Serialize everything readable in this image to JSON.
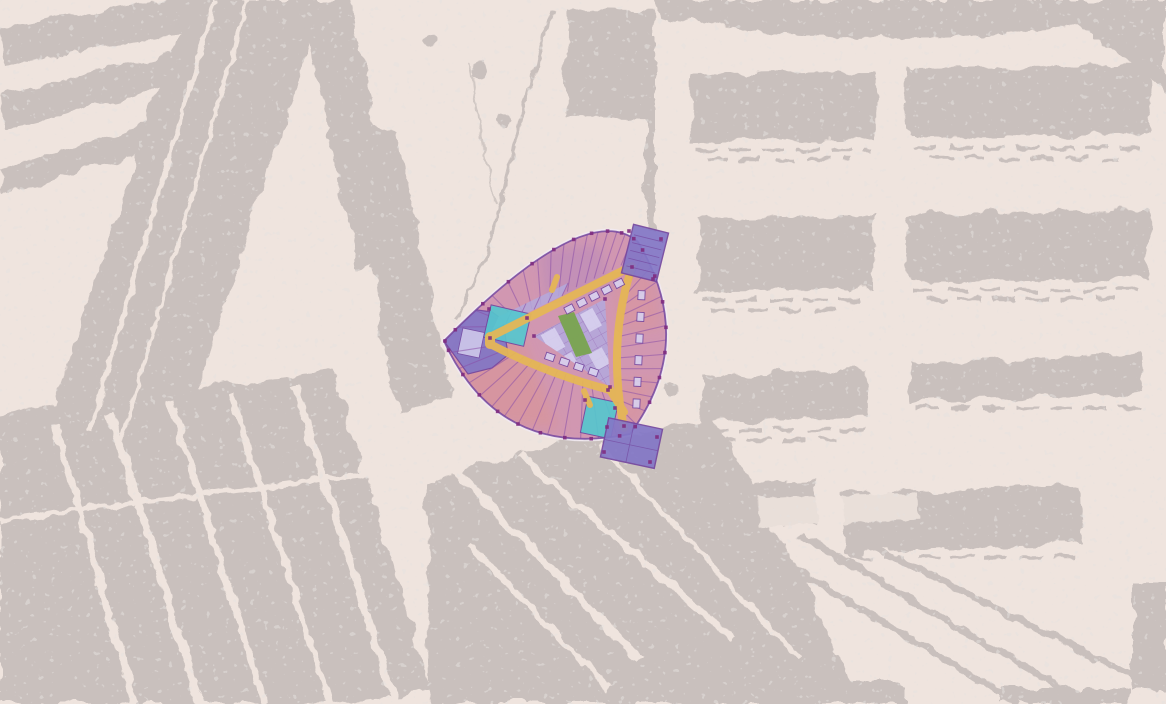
{
  "view": {
    "kind": "aerial-site-plan",
    "description_names": {
      "background": "posterized-aerial-map",
      "overlay": "building-floor-plan-overlay"
    }
  },
  "colors": {
    "map_background": "#EFE4DE",
    "map_block_gray": "#C9C0BD",
    "unit_pink": "#CB8AA9",
    "unit_salmon": "#DD9285",
    "accent_purple_tint": "#9F7FC0",
    "lavender": "#B4A9DC",
    "lavender_light": "#D8D2EF",
    "corridor_yellow": "#E5B757",
    "courtyard_green": "#79A44F",
    "core_cyan": "#56C6CE",
    "corner_block_purple": "#8377C6",
    "wall_purple": "#74479F",
    "partition_purple": "#8A4FA8",
    "column_dot_magenta": "#7F2C80",
    "plan_halo": "#F1EAF2"
  },
  "plan_zones": [
    {
      "name": "outer-ring-units-north",
      "color_key": "unit_pink"
    },
    {
      "name": "outer-ring-units-east",
      "color_key": "unit_pink"
    },
    {
      "name": "outer-ring-units-southwest",
      "color_key": "unit_pink"
    },
    {
      "name": "corner-block-northeast",
      "color_key": "corner_block_purple"
    },
    {
      "name": "corner-block-south",
      "color_key": "corner_block_purple"
    },
    {
      "name": "corner-block-west",
      "color_key": "corner_block_purple"
    },
    {
      "name": "stair-core-west",
      "color_key": "core_cyan"
    },
    {
      "name": "stair-core-south",
      "color_key": "core_cyan"
    },
    {
      "name": "central-courtyard-block",
      "color_key": "lavender"
    },
    {
      "name": "courtyard-green-strip",
      "color_key": "courtyard_green"
    },
    {
      "name": "corridor-network",
      "color_key": "corridor_yellow"
    }
  ],
  "map_features": [
    {
      "name": "row-block-grid-east",
      "rows": 4,
      "columns": 2
    },
    {
      "name": "diagonal-street-band-west"
    },
    {
      "name": "dense-urban-mass-south"
    },
    {
      "name": "curved-access-road-west-of-building"
    }
  ]
}
